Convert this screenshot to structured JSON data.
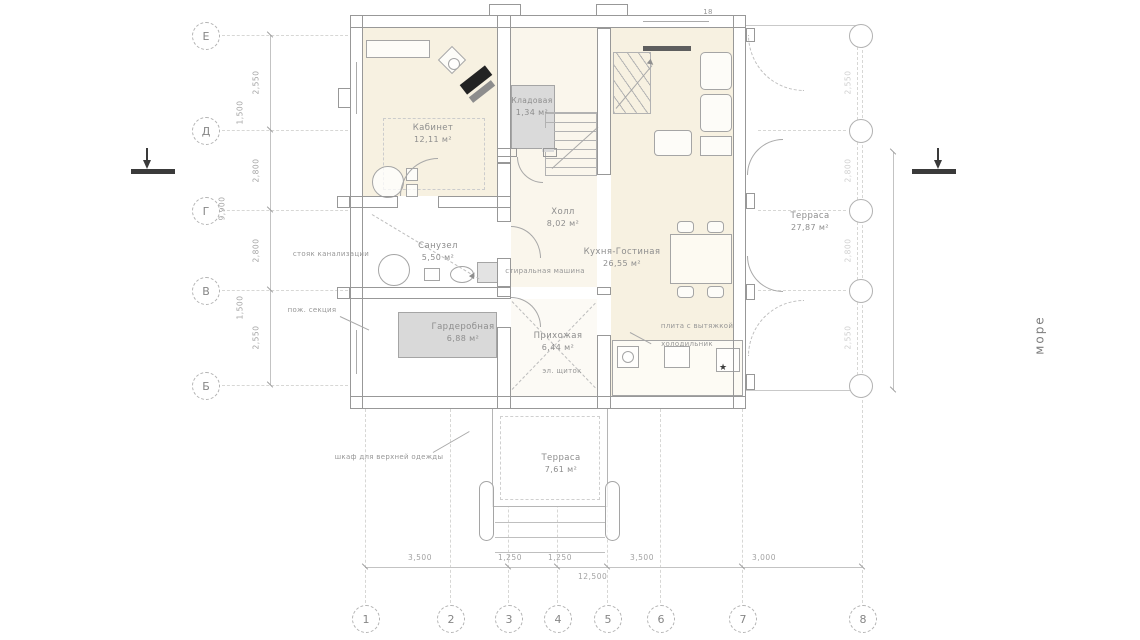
{
  "labels": {
    "sea": "море",
    "top_mark": "18",
    "star": "★"
  },
  "grid": {
    "cols": [
      "1",
      "2",
      "3",
      "4",
      "5",
      "6",
      "7",
      "8"
    ],
    "rows": [
      "Е",
      "Д",
      "Г",
      "В",
      "Б"
    ]
  },
  "rooms": {
    "office": {
      "name": "Кабинет",
      "area": "12,11 м²"
    },
    "storage": {
      "name": "Кладовая",
      "area": "1,34 м²"
    },
    "hall": {
      "name": "Холл",
      "area": "8,02 м²"
    },
    "bathroom": {
      "name": "Санузел",
      "area": "5,50 м²"
    },
    "kitchen_living": {
      "name": "Кухня-Гостиная",
      "area": "26,55 м²"
    },
    "wardrobe": {
      "name": "Гардеробная",
      "area": "6,88 м²"
    },
    "entry": {
      "name": "Прихожая",
      "area": "6,44 м²"
    },
    "terrace_right": {
      "name": "Терраса",
      "area": "27,87 м²"
    },
    "terrace_bottom": {
      "name": "Терраса",
      "area": "7,61 м²"
    }
  },
  "annotations": {
    "washing_machine": "стиральная машина",
    "stove_hood": "плита с вытяжкой",
    "fridge": "холодильник",
    "electrical_panel": "эл. щиток",
    "coat_closet": "шкаф для верхней одежды",
    "sewer_riser": "стояк канализации",
    "fire_section": "пож. секция"
  },
  "dimensions": {
    "bottom": [
      "3,500",
      "1,250",
      "1,250",
      "3,500",
      "3,000"
    ],
    "bottom_total": "12,500",
    "left": [
      "2,550",
      "2,800",
      "2,800",
      "2,550"
    ],
    "left_partials": [
      "1,500",
      "1,500"
    ],
    "left_total": "9,900",
    "right": [
      "2,550",
      "2,800",
      "2,800",
      "2,550"
    ]
  }
}
